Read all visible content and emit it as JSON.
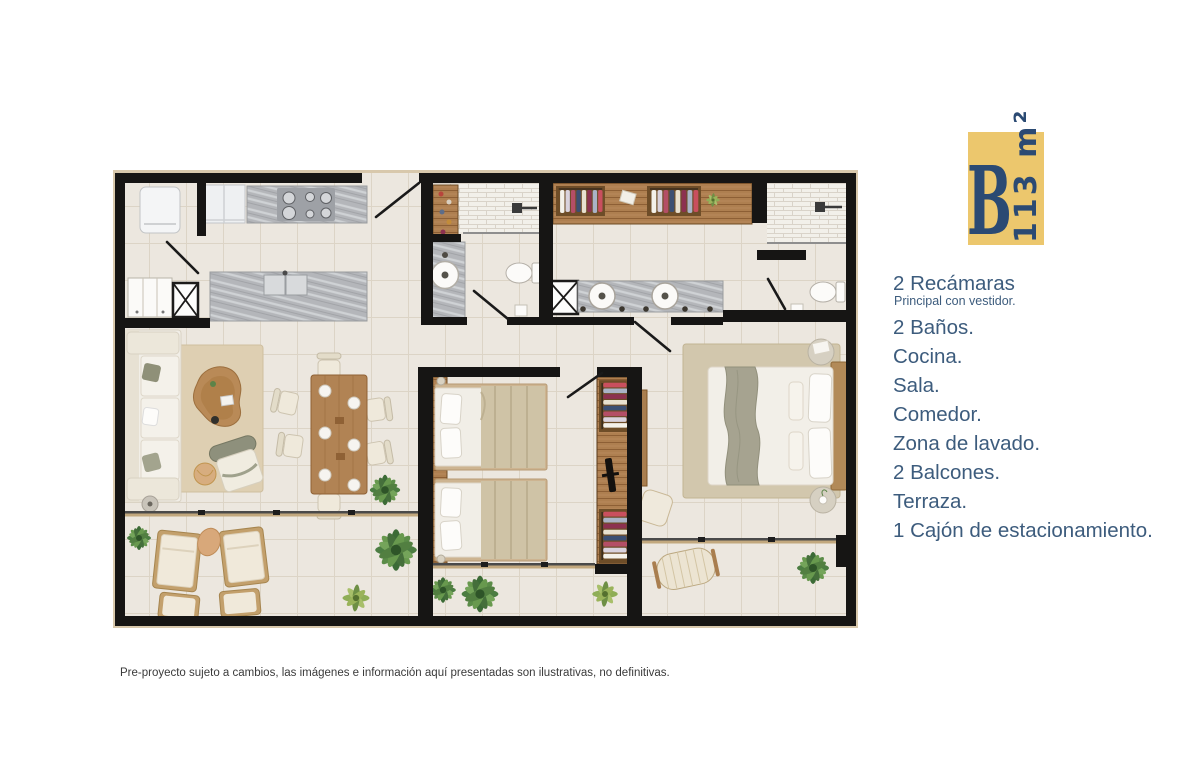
{
  "badge": {
    "letter": "B",
    "area": "113 m²",
    "bg_color": "#ecc76d",
    "text_color": "#2b4a73"
  },
  "features": {
    "text_color": "#3d5c7d",
    "items": [
      {
        "label": "2 Recámaras",
        "sub": "Principal con vestidor."
      },
      {
        "label": "2 Baños."
      },
      {
        "label": "Cocina."
      },
      {
        "label": "Sala."
      },
      {
        "label": "Comedor."
      },
      {
        "label": "Zona de lavado."
      },
      {
        "label": "2 Balcones."
      },
      {
        "label": "Terraza."
      },
      {
        "label": "1 Cajón de estacionamiento."
      }
    ]
  },
  "disclaimer": {
    "text": "Pre-proyecto sujeto a cambios, las imágenes e información aquí presentadas son ilustrativas, no definitivas."
  },
  "floorplan_colors": {
    "wall": "#161514",
    "floor": "#ece7df",
    "tile_line": "#dcd4c6",
    "marble": "#b4b6ba",
    "wood": "#ae7f50",
    "rug": "#decfb2",
    "plant_green": "#4c7d42",
    "linen": "#f1eee7"
  }
}
